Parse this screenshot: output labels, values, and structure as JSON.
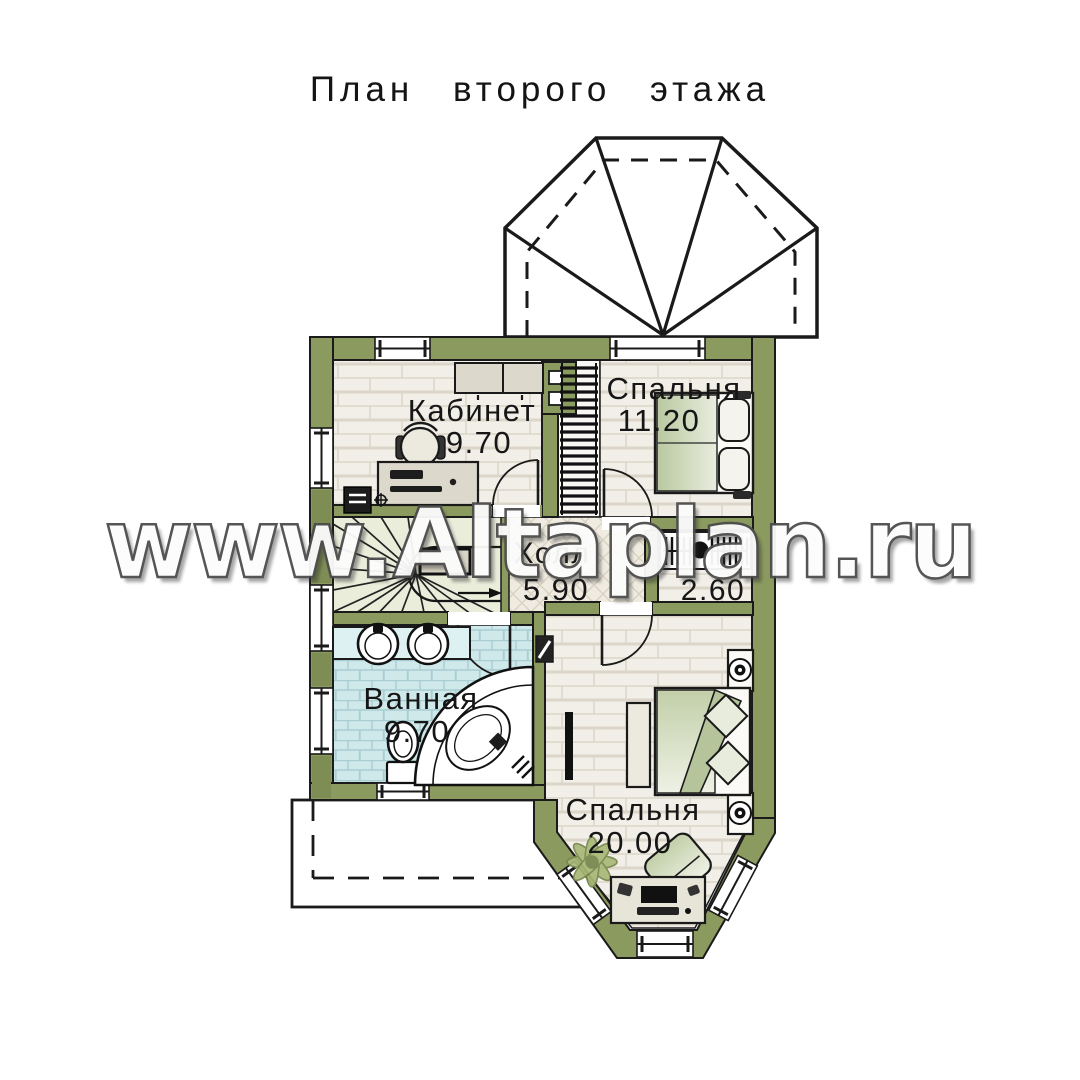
{
  "title": "План второго этажа",
  "watermark": "www.Altaplan.ru",
  "rooms": {
    "office": {
      "name": "Кабинет",
      "area": "9.70"
    },
    "bedroom1": {
      "name": "Спальня",
      "area": "11.20"
    },
    "hall": {
      "name": "Холл",
      "area": "5.90"
    },
    "wardrobe": {
      "name": "",
      "area": "2.60"
    },
    "bathroom": {
      "name": "Ванная",
      "area": "9.70"
    },
    "bedroom2": {
      "name": "Спальня",
      "area": "20.00"
    }
  },
  "colors": {
    "wall": "#8b9a5f",
    "wall_dark": "#7e8d53",
    "floor": "#f2efe8",
    "bathroom_floor": "#cfe9eb",
    "stairs_floor": "#e9edda",
    "hall_floor": "#efebe1",
    "line": "#1a1a1a"
  }
}
